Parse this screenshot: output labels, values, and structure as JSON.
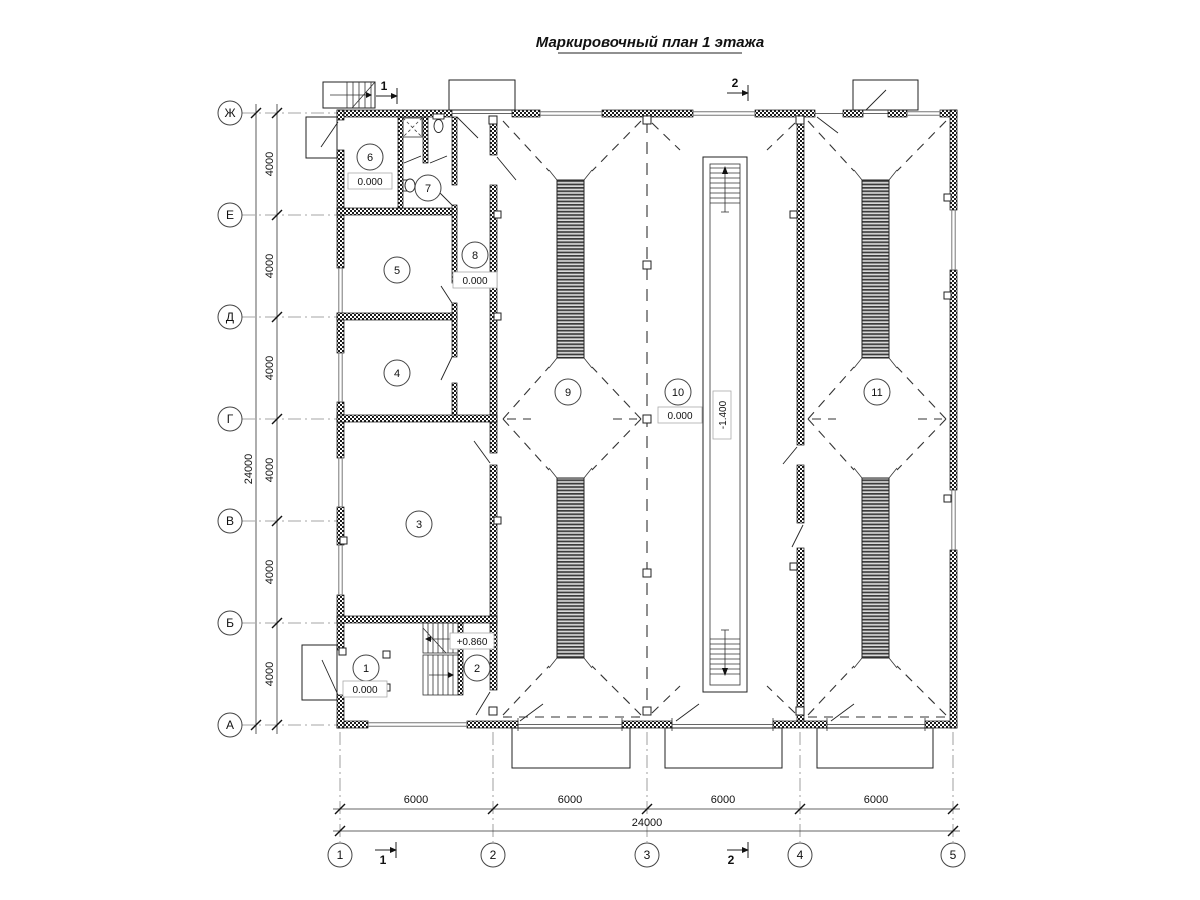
{
  "title": "Маркировочный план 1 этажа",
  "axes": {
    "rows": [
      "Ж",
      "Е",
      "Д",
      "Г",
      "В",
      "Б",
      "А"
    ],
    "cols": [
      "1",
      "2",
      "3",
      "4",
      "5"
    ]
  },
  "dimensions": {
    "left_segments": [
      "4000",
      "4000",
      "4000",
      "4000",
      "4000",
      "4000"
    ],
    "left_total": "24000",
    "bottom_segments": [
      "6000",
      "6000",
      "6000",
      "6000"
    ],
    "bottom_total": "24000"
  },
  "rooms": [
    {
      "num": "1",
      "elev": "0.000"
    },
    {
      "num": "2",
      "elev": "+0.860"
    },
    {
      "num": "3"
    },
    {
      "num": "4"
    },
    {
      "num": "5"
    },
    {
      "num": "6",
      "elev": "0.000"
    },
    {
      "num": "7"
    },
    {
      "num": "8",
      "elev": "0.000"
    },
    {
      "num": "9"
    },
    {
      "num": "10",
      "elev": "0.000"
    },
    {
      "num": "11"
    }
  ],
  "pit": {
    "elev": "-1.400"
  },
  "sections": {
    "one": "1",
    "two": "2"
  },
  "colors": {
    "line": "#222222",
    "background": "#ffffff"
  }
}
